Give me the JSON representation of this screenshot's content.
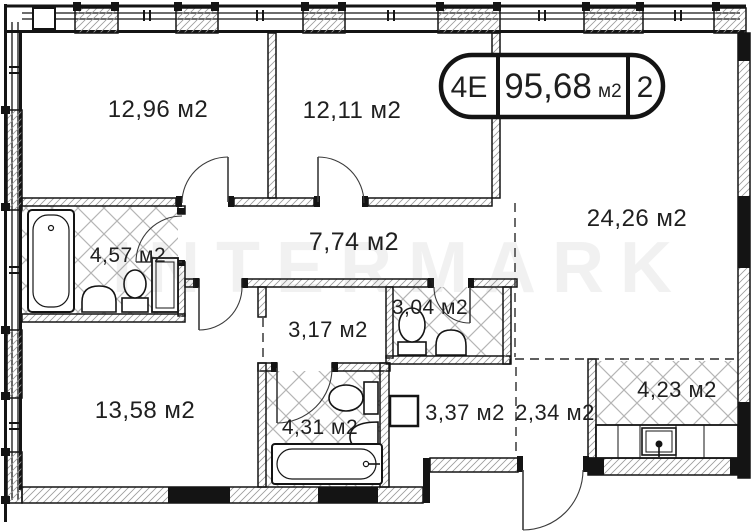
{
  "plan": {
    "title_box": {
      "block": "4E",
      "total_area": "95,68",
      "unit": "м2",
      "room_count": "2"
    },
    "watermark": "INTERMARK",
    "rooms": [
      {
        "id": "bedroom-1",
        "label": "12,96 м2"
      },
      {
        "id": "bedroom-2",
        "label": "12,11 м2"
      },
      {
        "id": "living-room",
        "label": "24,26 м2"
      },
      {
        "id": "corridor",
        "label": "7,74 м2"
      },
      {
        "id": "bathroom-1",
        "label": "4,57 м2"
      },
      {
        "id": "hall",
        "label": "3,17 м2"
      },
      {
        "id": "wc",
        "label": "3,04 м2"
      },
      {
        "id": "bedroom-3",
        "label": "13,58 м2"
      },
      {
        "id": "bathroom-2",
        "label": "4,31 м2"
      },
      {
        "id": "hallway",
        "label": "3,37 м2"
      },
      {
        "id": "entry",
        "label": "2,34 м2"
      },
      {
        "id": "kitchen",
        "label": "4,23 м2"
      }
    ],
    "colors": {
      "wall": "#141414",
      "floor_hatch": "#b5b5b5",
      "wall_hatch": "#8f8f8f",
      "background": "#ffffff"
    }
  }
}
